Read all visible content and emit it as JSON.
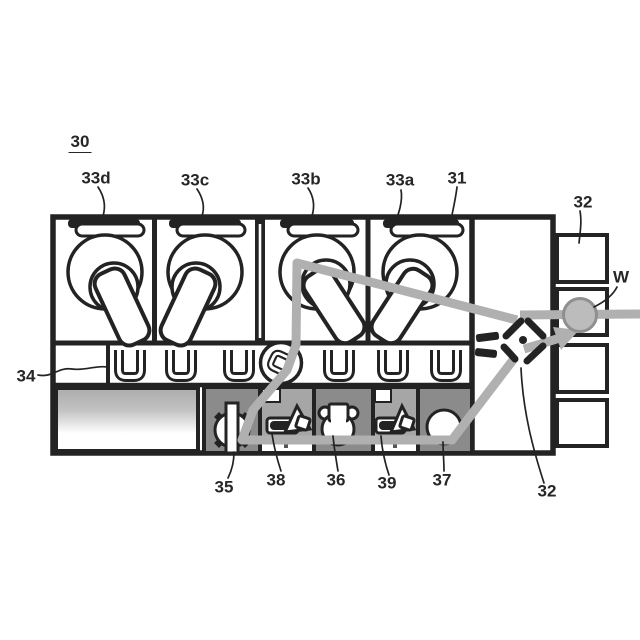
{
  "figure_labels": {
    "l30": "30",
    "l33d": "33d",
    "l33c": "33c",
    "l33b": "33b",
    "l33a": "33a",
    "l31": "31",
    "l32_top": "32",
    "lW": "W",
    "l34": "34",
    "l35": "35",
    "l38": "38",
    "l36": "36",
    "l39": "39",
    "l37": "37",
    "l32_bottom": "32"
  },
  "colors": {
    "line": "#232323",
    "path": "#b0b0b0",
    "cellDark": "#8b8b8b",
    "cellLight": "#a6a6a6",
    "waferFill": "#bcbcbc",
    "waferEdge": "#8f8f8f"
  }
}
